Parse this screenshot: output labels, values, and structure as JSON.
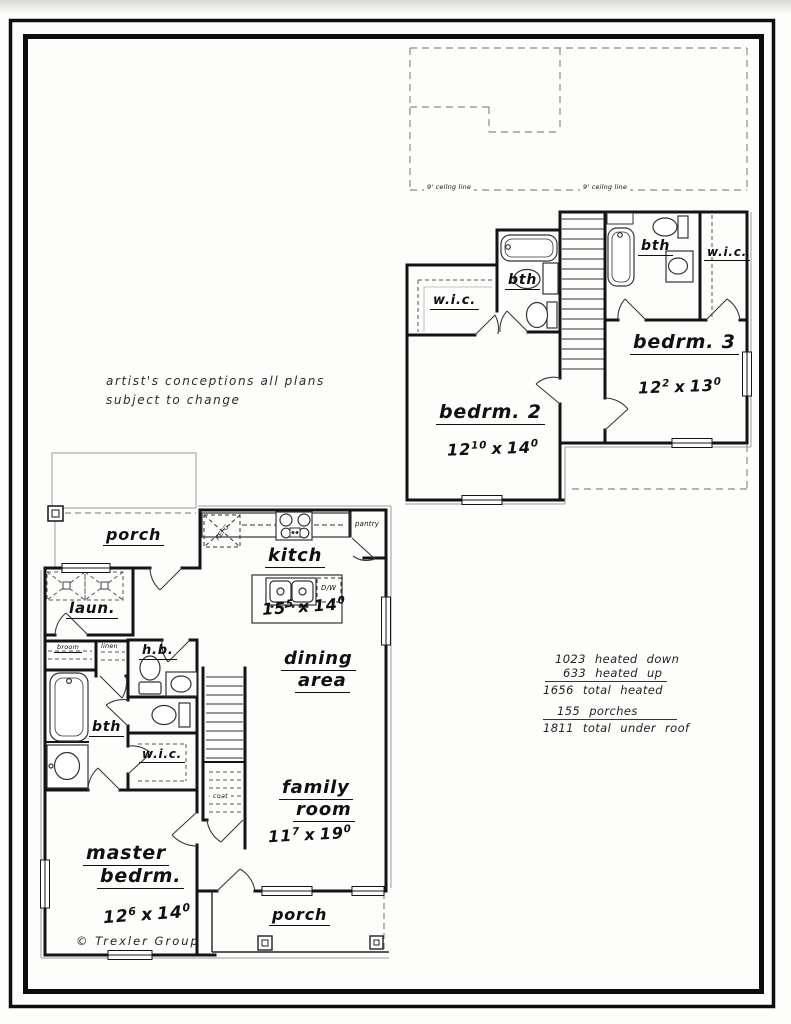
{
  "notes": {
    "artist_line1": "artist's conceptions all plans",
    "artist_line2": "subject to change",
    "copyright": "© Trexler Group"
  },
  "upper_floor": {
    "ceiling_line_left": "9' ceilng line",
    "ceiling_line_right": "9' ceilng line",
    "wic_bedrm2": "w.i.c.",
    "bath2": "bth",
    "bath3": "bth",
    "wic_bedrm3": "w.i.c.",
    "bedrm2": {
      "name": "bedrm. 2",
      "dim": {
        "w": "12",
        "w_in": "10",
        "sep": "x",
        "h": "14",
        "h_in": "0"
      }
    },
    "bedrm3": {
      "name": "bedrm. 3",
      "dim": {
        "w": "12",
        "w_in": "2",
        "sep": "x",
        "h": "13",
        "h_in": "0"
      }
    }
  },
  "lower_floor": {
    "porch_top": "porch",
    "kitchen": {
      "name": "kitch",
      "dim": {
        "w": "15",
        "w_in": "5",
        "sep": "x",
        "h": "14",
        "h_in": "0"
      }
    },
    "pantry": "pantry",
    "dishwasher": "D/W",
    "refrigerator": "REFG.",
    "laundry": "laun.",
    "broom": "broom",
    "linen": "linen",
    "half_bath": "h.b.",
    "bath": "bth",
    "wic": "w.i.c.",
    "coat": "coat",
    "dining": {
      "line1": "dining",
      "line2": "area"
    },
    "family": {
      "line1": "family",
      "line2": "room",
      "dim": {
        "w": "11",
        "w_in": "7",
        "sep": "x",
        "h": "19",
        "h_in": "0"
      }
    },
    "master": {
      "line1": "master",
      "line2": "bedrm.",
      "dim": {
        "w": "12",
        "w_in": "6",
        "sep": "x",
        "h": "14",
        "h_in": "0"
      }
    },
    "porch_bottom": "porch"
  },
  "area_stats": {
    "lines": [
      "1023 heated down",
      "633 heated up",
      "1656 total heated",
      "155 porches",
      "1811 total under roof"
    ]
  }
}
